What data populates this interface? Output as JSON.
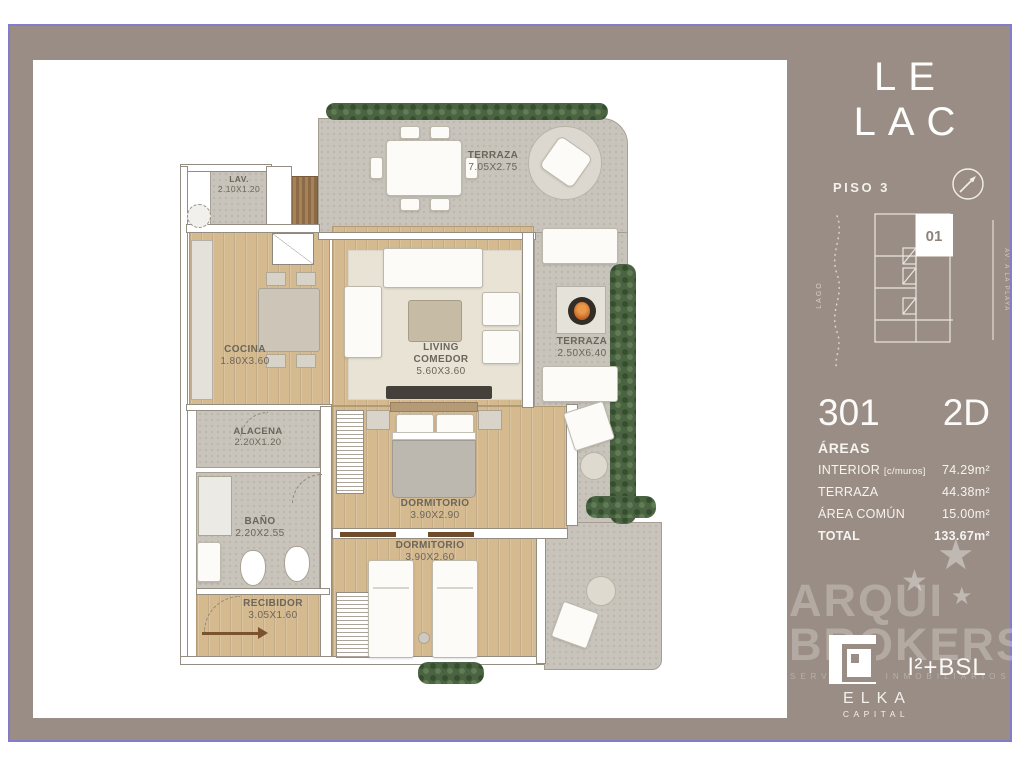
{
  "frame": {
    "border_color": "#837cc9",
    "panel_color": "#998d85"
  },
  "sidebar": {
    "title": "LE LAC",
    "floor_label": "PISO 3",
    "key_plan": {
      "unit": "01",
      "left_label": "LAGO",
      "right_label": "AV. A LA PLAYA"
    },
    "unit_number": "301",
    "typology": "2D",
    "areas": {
      "header": "ÁREAS",
      "rows": [
        {
          "label": "INTERIOR",
          "note": "[c/muros]",
          "value": "74.29m²"
        },
        {
          "label": "TERRAZA",
          "note": "",
          "value": "44.38m²"
        },
        {
          "label": "ÁREA COMÚN",
          "note": "",
          "value": "15.00m²"
        },
        {
          "label": "TOTAL",
          "note": "",
          "value": "133.67m²"
        }
      ]
    },
    "watermark": {
      "line1": "ARQUI",
      "line2": "BROKERS",
      "subline": "SERVICIOS INMOBILIARIOS"
    },
    "partner_logo": "l²+BSL",
    "developer": {
      "name": "ELKA",
      "sub": "CAPITAL"
    }
  },
  "plan": {
    "rooms": [
      {
        "id": "terraza_top",
        "name": "TERRAZA",
        "dims": "7.05x2.75"
      },
      {
        "id": "lav",
        "name": "LAV.",
        "dims": "2.10x1.20"
      },
      {
        "id": "cocina",
        "name": "COCINA",
        "dims": "1.80x3.60"
      },
      {
        "id": "living",
        "name": "LIVING",
        "name2": "COMEDOR",
        "dims": "5.60x3.60"
      },
      {
        "id": "terraza_right",
        "name": "TERRAZA",
        "dims": "2.50x6.40"
      },
      {
        "id": "alacena",
        "name": "ALACENA",
        "dims": "2.20x1.20"
      },
      {
        "id": "bano",
        "name": "BAÑO",
        "dims": "2.20x2.55"
      },
      {
        "id": "dorm1",
        "name": "DORMITORIO",
        "dims": "3.90x2.90"
      },
      {
        "id": "dorm2",
        "name": "DORMITORIO",
        "dims": "3.90x2.60"
      },
      {
        "id": "recibidor",
        "name": "RECIBIDOR",
        "dims": "3.05x1.60"
      }
    ]
  }
}
